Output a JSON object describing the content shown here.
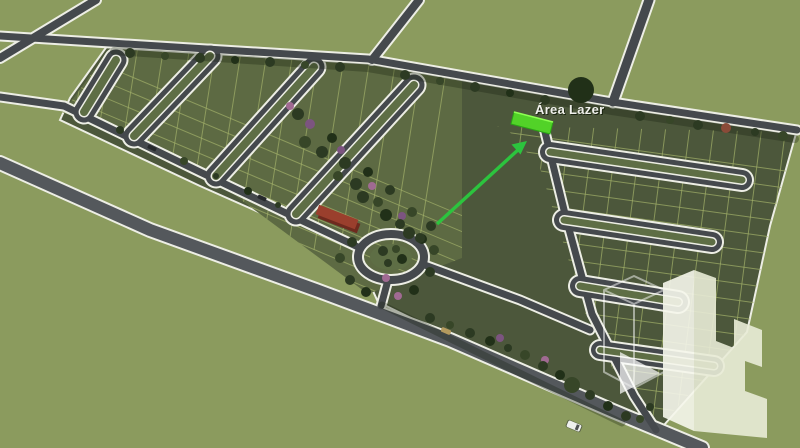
{
  "annotation": {
    "label": "Área Lazer"
  },
  "landmarks": {
    "highlighted_lot": "leisure-area-lot",
    "arrow": "green-pointer-arrow",
    "roundabout": "entrance-roundabout",
    "entrance_building": "red-roof-entrance-building",
    "subdivision": "lot-subdivision-masterplan",
    "watermark_icon": "city-buildings-logo"
  },
  "vehicles": {
    "van": "white-van",
    "car1": "tan-car",
    "car2": "dark-car",
    "car3": "dark-car"
  },
  "colors": {
    "field": "#8b9b5e",
    "band": "#4c573b",
    "band_left": "#5d6a43",
    "island": "#5e6e45",
    "plot_line": "#a3b06a",
    "road": "#45494d",
    "road_light": "#54585c",
    "curb": "#edeee5",
    "tree1": "#2c3a22",
    "tree2": "#374628",
    "tree3": "#213018",
    "tree_pink": "#a06a92",
    "tree_purple": "#7c5480",
    "tree_red": "#8a4a38",
    "bldg_red": "#9a3f2d",
    "bldg_red_dark": "#6e2a1e",
    "hl_fill": "#52d228",
    "hl_edge": "#2aa515",
    "hl_shine": "#8dff52",
    "arrow": "#2cc43e",
    "label": "#f0f0ec",
    "label_shadow": "#1a2410",
    "logo_lit": "#f6f7ec",
    "logo_face": "#e9ecd7",
    "logo_line": "rgba(255,255,255,0.55)",
    "logo_arrow": "rgba(255,255,255,0.78)",
    "van": "#eef0ee",
    "car_tan": "#b49a5e",
    "car_dark": "#26292c"
  }
}
